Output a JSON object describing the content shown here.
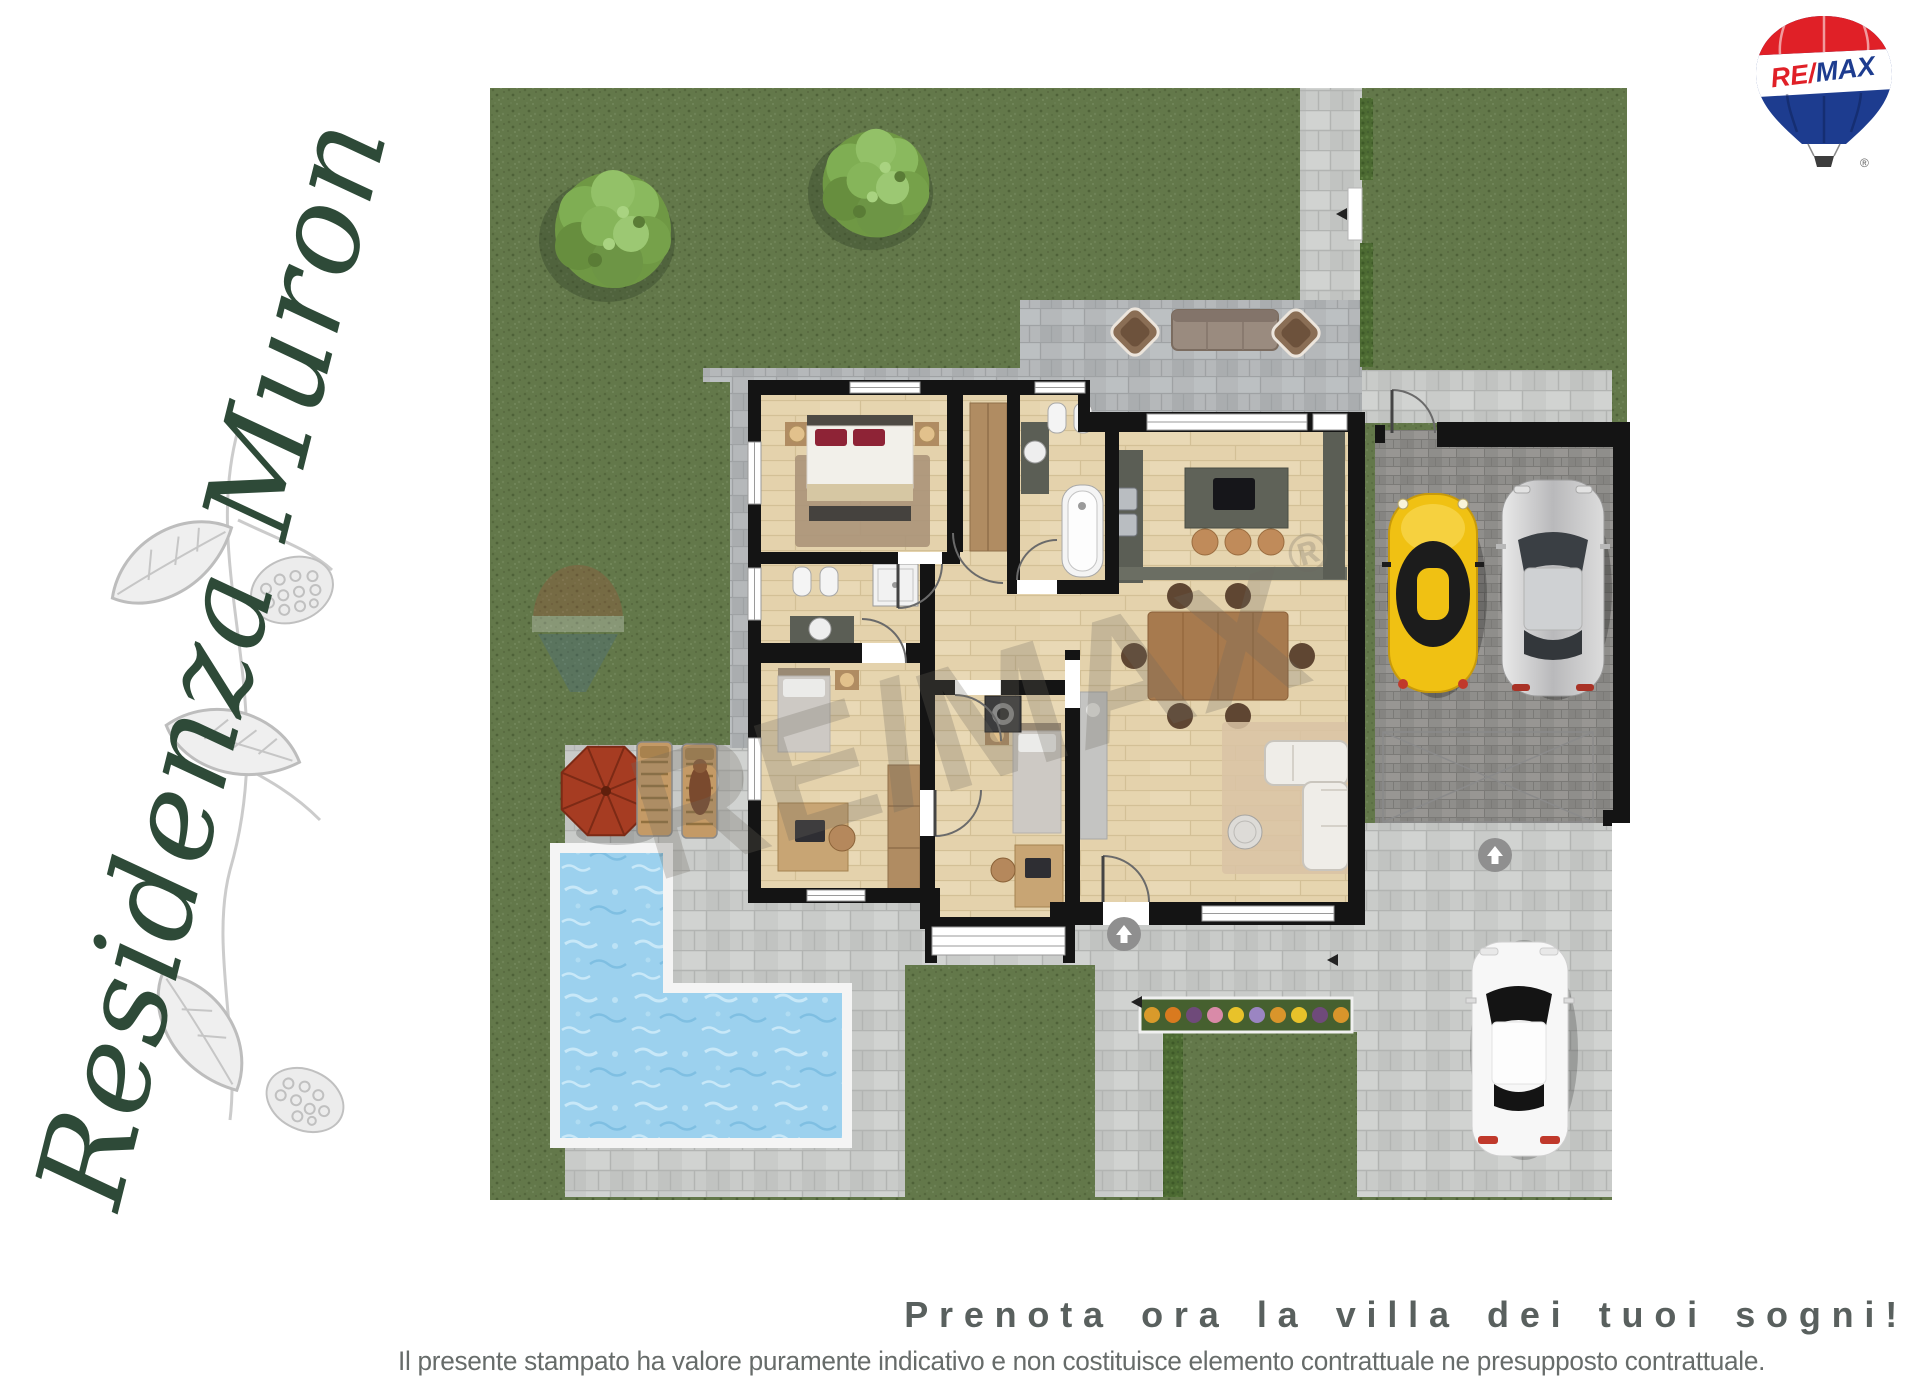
{
  "page": {
    "background": "#ffffff",
    "width": 1920,
    "height": 1390
  },
  "branding": {
    "residence_name": "Residenza Muron",
    "text_color": "#2e4a38",
    "illustration": "mulberry-branch-sketch",
    "illustration_color": "#c3c3c3"
  },
  "logo": {
    "name": "remax-balloon-logo",
    "re": "RE",
    "slash": "/",
    "max": "MAX",
    "registered": "®",
    "colors": {
      "red": "#e02027",
      "blue": "#1d3c8f",
      "white": "#ffffff",
      "basket": "#3d3d3d"
    }
  },
  "watermark": {
    "text": "RE/MAX",
    "registered": "®",
    "color": "#6e6a60"
  },
  "footer": {
    "headline": "Prenota ora la villa dei tuoi sogni!",
    "headline_color": "#59605e",
    "disclaimer": "Il presente stampato ha valore puramente indicativo e non costituisce elemento contrattuale ne presupposto contrattuale.",
    "disclaimer_color": "#676c6a"
  },
  "plan": {
    "type": "residential-floor-plan-top-view",
    "colors": {
      "grass": "#63784a",
      "pool_water": "#9cd1ee",
      "pavers_light": "#c9cbc9",
      "pavers_patio": "#b5b8ba",
      "pavers_garage": "#8f8e8b",
      "wood_floor": "#e8d8b5",
      "walls": "#141414",
      "hedge": "#4c6a32",
      "umbrella": "#a63c22",
      "car_yellow": "#f0c113",
      "car_silver": "#c9c9c9",
      "car_white": "#f7f7f7"
    },
    "features": [
      "garden-lawn",
      "two-trees",
      "l-shaped-pool",
      "sun-umbrella",
      "two-sun-loungers",
      "outdoor-lounge-set",
      "double-garage-with-two-cars",
      "driveway-with-white-car",
      "flower-bed",
      "hedges",
      "master-bedroom",
      "two-single-bedrooms",
      "two-bathrooms",
      "kitchen-with-island",
      "living-dining-room",
      "entrance-arrows"
    ]
  }
}
